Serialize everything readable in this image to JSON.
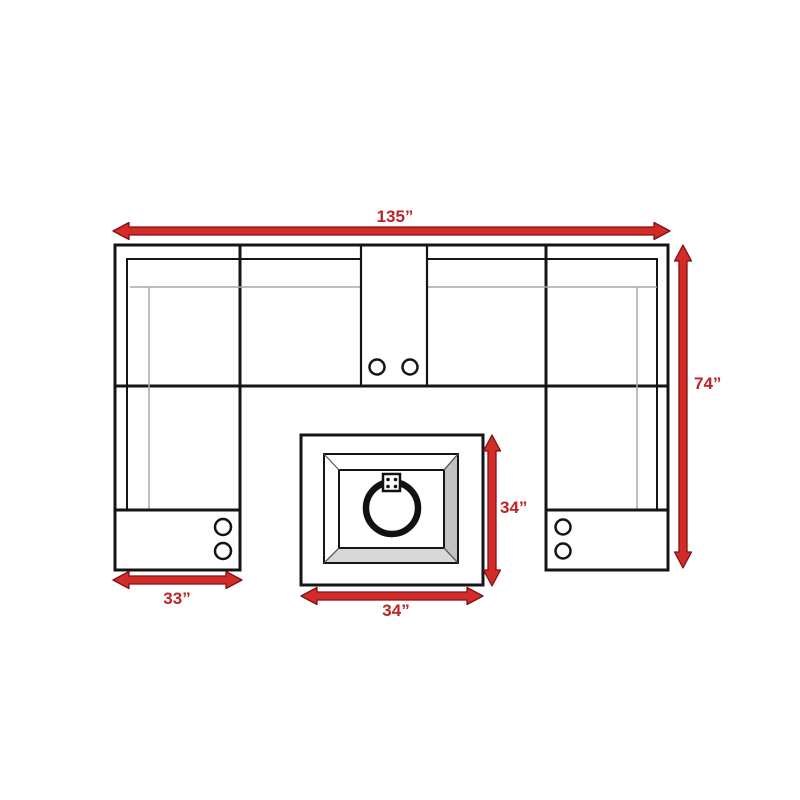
{
  "canvas": {
    "background": "#ffffff"
  },
  "diagram": {
    "subject": "u-shaped-sectional-sofa-with-center-console-end-tables-and-fire-pit-table-top-view",
    "dimensions": {
      "overall_width": "135”",
      "overall_depth": "74”",
      "end_table_width": "33”",
      "fire_pit_depth": "34”",
      "fire_pit_width": "34”"
    },
    "colors": {
      "dimension_arrow": "#d42a28",
      "dimension_arrow_outline": "#7e1315",
      "dimension_text": "#bf2227",
      "furniture_outline": "#151515",
      "secondary_line": "#a8a8a8",
      "fire_pit_bevel_side": "#c2c2c2",
      "fire_pit_bevel_bottom": "#d8d8d8"
    }
  }
}
